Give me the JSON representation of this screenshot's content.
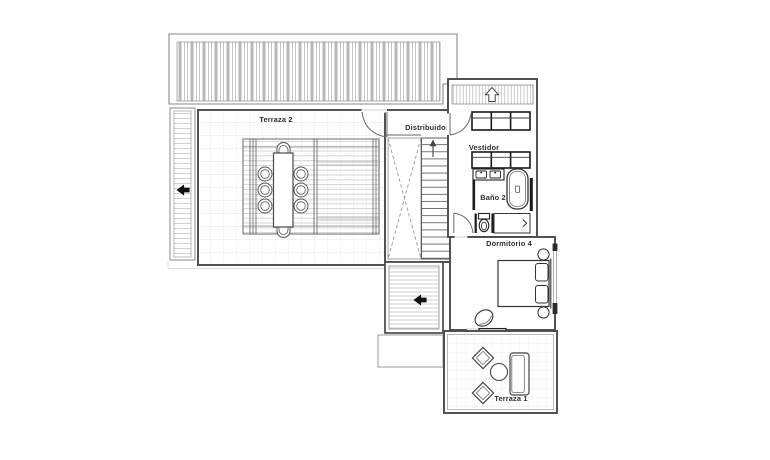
{
  "plan": {
    "rooms": {
      "terraza2": {
        "label": "Terraza 2"
      },
      "distribuidor": {
        "label": "Distribuidor"
      },
      "vestidor": {
        "label": "Vestidor"
      },
      "bano2": {
        "label": "Baño 2"
      },
      "dormitorio4": {
        "label": "Dormitorio 4"
      },
      "terraza1": {
        "label": "Terraza 1"
      }
    },
    "icons": {
      "left_arrow": "◀ solid black direction arrow (planter walkway and lower roof deck)",
      "stairs_up_arrow": "↑ stair run direction arrow",
      "hollow_up_arrow": "⇧ outline arrow on louvered window strip",
      "shower_arrow": "› small arrow inside shower recess"
    },
    "fixtures": [
      "pergola-slatted-roof",
      "dining-table-8-seats",
      "stair-flight",
      "double-height-void",
      "wardrobe-row-1",
      "wardrobe-row-2",
      "double-sink-vanity",
      "bathtub",
      "toilet",
      "shower",
      "double-bed",
      "pillows",
      "bedside-lamps",
      "armchair",
      "sliding-door",
      "lounge-chair-1",
      "lounge-chair-2",
      "round-side-table",
      "outdoor-sofa"
    ],
    "colors": {
      "background": "#ffffff",
      "wall": "#4a4a4a",
      "wall_dark": "#1a1a1a",
      "tile_grid": "#dedede",
      "deck_line": "#cccccc",
      "slat_gray": "#b8b8b8",
      "dash": "#9a9a9a",
      "label_text": "#2e2e2e"
    }
  }
}
